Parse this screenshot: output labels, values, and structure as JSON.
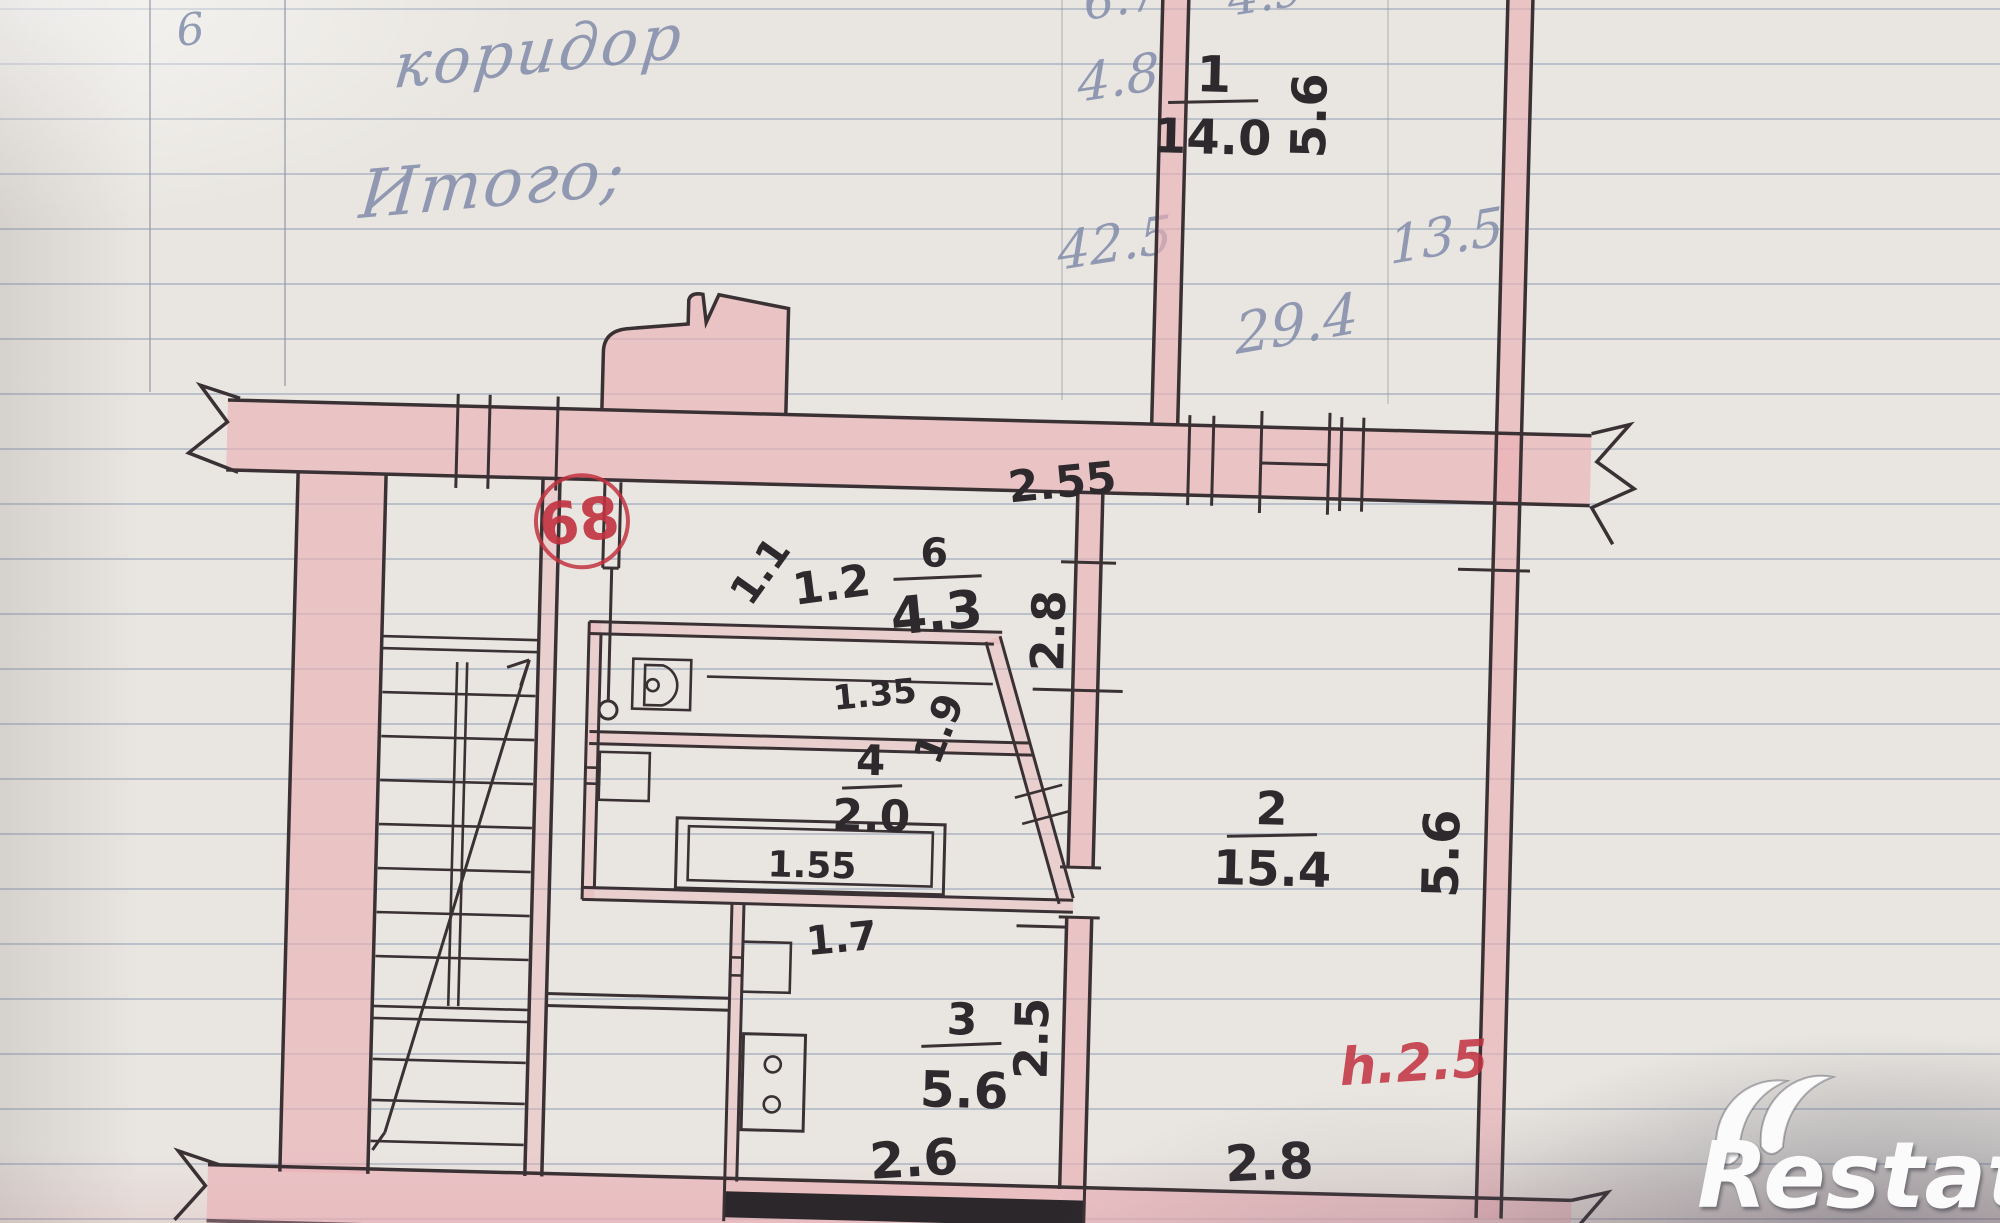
{
  "handwriting": {
    "margin_digit": "6",
    "corridor": "коридор",
    "total": "Итого;",
    "v48": "4.8",
    "v425": "42.5",
    "v135": "13.5",
    "v294": "29.4",
    "partial_left": "6.7",
    "partial_right": "4.9"
  },
  "plan": {
    "apartment_number": "68",
    "height_note": "h.2.5",
    "rooms": [
      {
        "number": "1",
        "area": "14.0"
      },
      {
        "number": "2",
        "area": "15.4"
      },
      {
        "number": "3",
        "area": "5.6"
      },
      {
        "number": "4",
        "area": "2.0"
      },
      {
        "number": "6",
        "area": "4.3"
      }
    ],
    "dims": {
      "top_56": "5.6",
      "right_56": "5.6",
      "w255": "2.55",
      "w11": "1.1",
      "w12": "1.2",
      "v28": "2.8",
      "w135": "1.35",
      "w19": "1.9",
      "w155": "1.55",
      "w17": "1.7",
      "v25": "2.5",
      "w26": "2.6",
      "w28b": "2.8"
    }
  },
  "watermark": {
    "brand": "Restate"
  },
  "colors": {
    "wall_fill": "#eab0b6",
    "wall_line": "#3a3134",
    "ink": "#2d292d",
    "red_ink": "#c23240",
    "pencil": "#7e89a8",
    "paper": "#e9e6e1"
  }
}
